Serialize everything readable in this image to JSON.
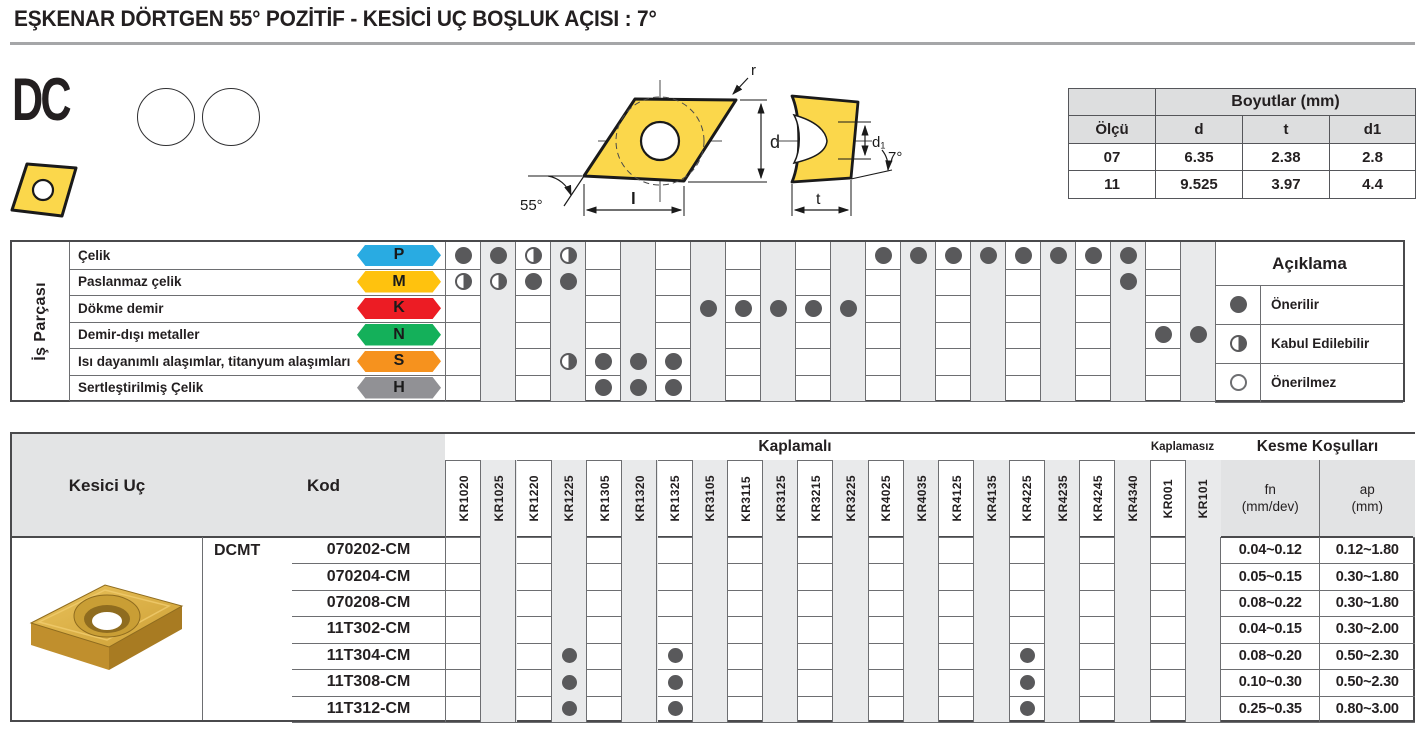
{
  "page_title": "EŞKENAR DÖRTGEN 55° POZİTİF - KESİCİ UÇ BOŞLUK AÇISI : 7°",
  "product": {
    "code": "DC"
  },
  "drawing": {
    "labels": {
      "r": "r",
      "d": "d",
      "l": "l",
      "angle_corner": "55°",
      "d1": "d₁",
      "t": "t",
      "angle_clearance": "7°"
    }
  },
  "dimensions_table": {
    "title": "Boyutlar (mm)",
    "col_headers": {
      "size": "Ölçü",
      "d": "d",
      "t": "t",
      "d1": "d1"
    },
    "rows": [
      {
        "size": "07",
        "d": "6.35",
        "t": "2.38",
        "d1": "2.8"
      },
      {
        "size": "11",
        "d": "9.525",
        "t": "3.97",
        "d1": "4.4"
      }
    ]
  },
  "workpiece_table": {
    "header": "İş Parçası",
    "rows": [
      {
        "label": "Çelik",
        "letter": "P",
        "color": "#29ABE2",
        "full": [
          0,
          1,
          12,
          13,
          14,
          15,
          16,
          17,
          18,
          19
        ],
        "half": [
          2,
          3
        ]
      },
      {
        "label": "Paslanmaz çelik",
        "letter": "M",
        "color": "#FFC20E",
        "full": [
          2,
          3,
          19
        ],
        "half": [
          0,
          1
        ]
      },
      {
        "label": "Dökme demir",
        "letter": "K",
        "color": "#EC1C24",
        "full": [
          7,
          8,
          9,
          10,
          11
        ],
        "half": []
      },
      {
        "label": "Demir-dışı metaller",
        "letter": "N",
        "color": "#14B05A",
        "full": [
          20,
          21
        ],
        "half": []
      },
      {
        "label": "Isı dayanımlı alaşımlar, titanyum alaşımları",
        "letter": "S",
        "color": "#F6921E",
        "full": [
          4,
          5,
          6
        ],
        "half": [
          3
        ]
      },
      {
        "label": "Sertleştirilmiş Çelik",
        "letter": "H",
        "color": "#919195",
        "full": [
          4,
          5,
          6
        ],
        "half": []
      }
    ]
  },
  "legend": {
    "title": "Açıklama",
    "items": [
      {
        "label": "Önerilir",
        "symbol": "full"
      },
      {
        "label": "Kabul Edilebilir",
        "symbol": "half"
      },
      {
        "label": "Önerilmez",
        "symbol": "none"
      }
    ]
  },
  "grades": {
    "coated_header": "Kaplamalı",
    "uncoated_header": "Kaplamasız",
    "columns": [
      "KR1020",
      "KR1025",
      "KR1220",
      "KR1225",
      "KR1305",
      "KR1320",
      "KR1325",
      "KR3105",
      "KR3115",
      "KR3125",
      "KR3215",
      "KR3225",
      "KR4025",
      "KR4035",
      "KR4125",
      "KR4135",
      "KR4225",
      "KR4235",
      "KR4245",
      "KR4340",
      "KR001",
      "KR101"
    ]
  },
  "cutting_table": {
    "insert_header": "Kesici Uç",
    "code_header": "Kod",
    "conditions_header": "Kesme Koşulları",
    "fn_label": "fn",
    "fn_unit": "(mm/dev)",
    "ap_label": "ap",
    "ap_unit": "(mm)",
    "series": "DCMT",
    "rows": [
      {
        "code": "070202-CM",
        "fn": "0.04~0.12",
        "ap": "0.12~1.80",
        "dots": []
      },
      {
        "code": "070204-CM",
        "fn": "0.05~0.15",
        "ap": "0.30~1.80",
        "dots": []
      },
      {
        "code": "070208-CM",
        "fn": "0.08~0.22",
        "ap": "0.30~1.80",
        "dots": []
      },
      {
        "code": "11T302-CM",
        "fn": "0.04~0.15",
        "ap": "0.30~2.00",
        "dots": []
      },
      {
        "code": "11T304-CM",
        "fn": "0.08~0.20",
        "ap": "0.50~2.30",
        "dots": [
          3,
          6,
          16
        ]
      },
      {
        "code": "11T308-CM",
        "fn": "0.10~0.30",
        "ap": "0.50~2.30",
        "dots": [
          3,
          6,
          16
        ]
      },
      {
        "code": "11T312-CM",
        "fn": "0.25~0.35",
        "ap": "0.80~3.00",
        "dots": [
          3,
          6,
          16
        ]
      }
    ]
  },
  "colors": {
    "dot": "#59595B",
    "insert_yellow": "#FBD74B",
    "grid_line": "#6D6E71",
    "alt_column": "#E9EAEB",
    "header_bg": "#E2E3E4"
  }
}
